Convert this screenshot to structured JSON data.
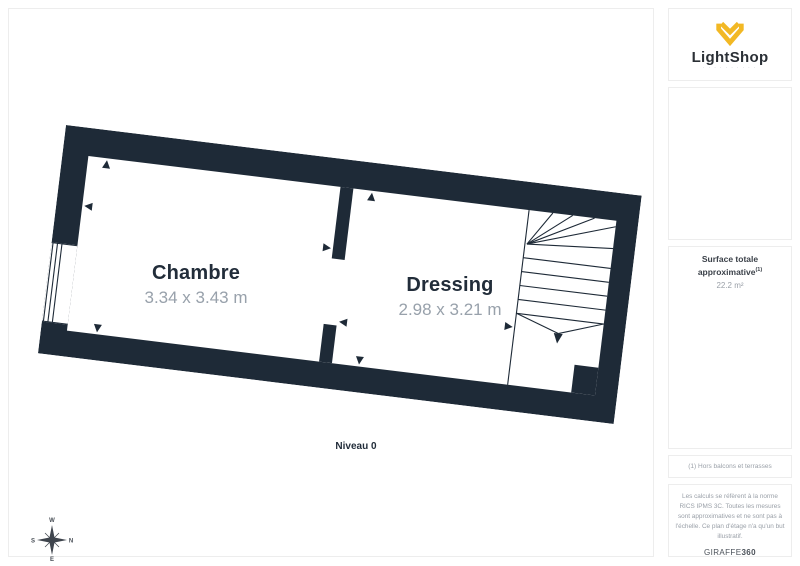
{
  "brand": {
    "logo_text": "LightShop",
    "tagline": "· · · · · · · · · ·",
    "logo_color": "#F2B824"
  },
  "sidebar": {
    "surface_label": "Surface totale approximative",
    "surface_sup": "(1)",
    "surface_value": "22.2 m²",
    "footnote": "(1) Hors balcons et terrasses",
    "legal": "Les calculs se réfèrent à la norme RICS IPMS 3C. Toutes les mesures sont approximatives et ne sont pas à l'échelle. Ce plan d'étage n'a qu'un but illustratif.",
    "credit_brand": "GIRAFFE",
    "credit_suffix": "360"
  },
  "floorplan": {
    "level_label": "Niveau 0",
    "rooms": [
      {
        "name": "Chambre",
        "dimensions": "3.34 x 3.43 m"
      },
      {
        "name": "Dressing",
        "dimensions": "2.98 x 3.21 m"
      }
    ],
    "features": [
      "window-left-wall",
      "door-opening-between-rooms",
      "winder-staircase-right"
    ],
    "rotation_deg": 7
  },
  "compass": {
    "top": "W",
    "right": "N",
    "bottom": "E",
    "left": "S"
  },
  "colors": {
    "wall": "#1E2A37",
    "accent": "#F2B824",
    "text_dark": "#222D3A",
    "text_gray": "#98A1AB",
    "border": "#EDEDED"
  }
}
